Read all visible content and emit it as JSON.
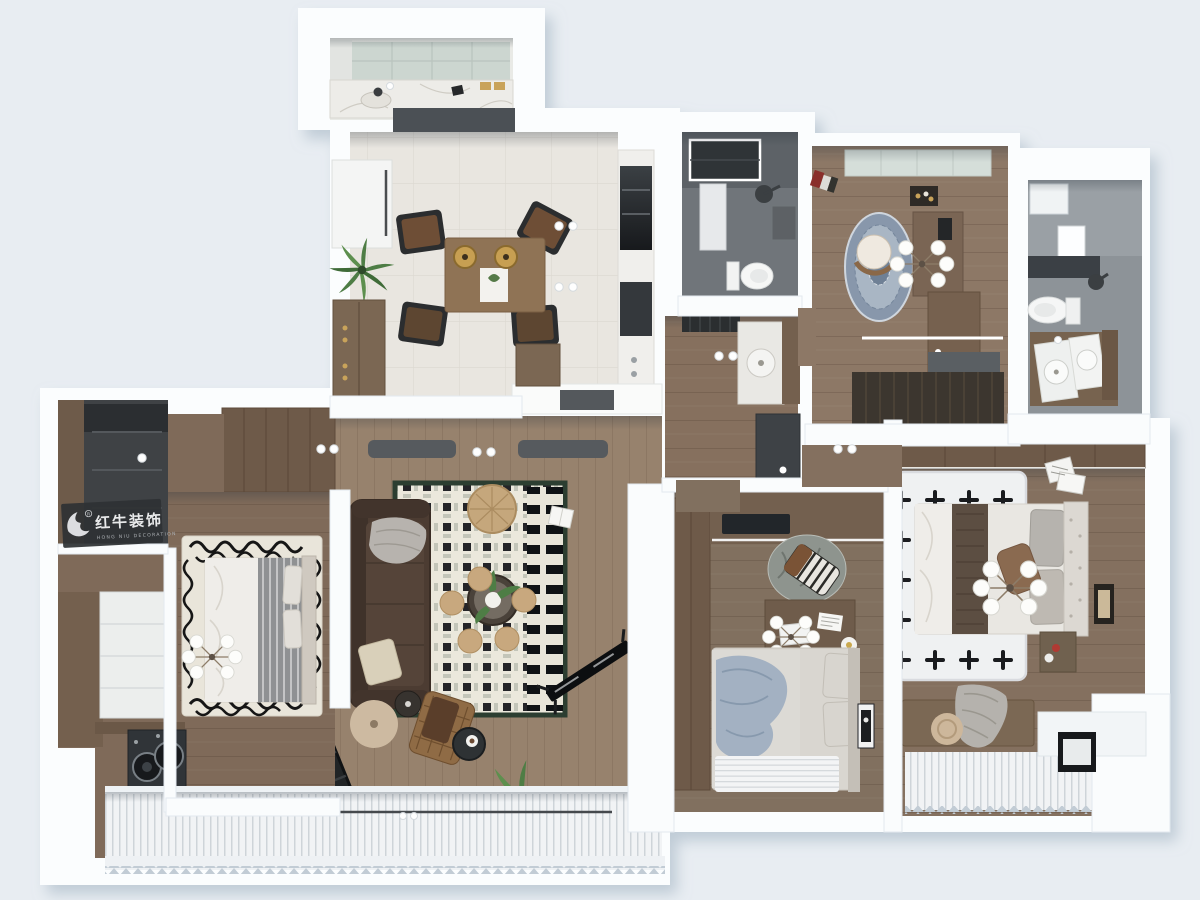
{
  "watermark": {
    "brand_cn": "红牛装饰",
    "brand_en": "HONG NIU DECORATION",
    "registered_mark": "R"
  },
  "palette": {
    "background": "#e8edf2",
    "wall": "#fbfdfe",
    "wall_edge": "#dde5ec",
    "wood_hall": "#97826d",
    "wood_bedroom": "#7f6a59",
    "wood_mid": "#81705f",
    "wood_master": "#84705f",
    "wood_study": "#8d7866",
    "wood_entry": "#86705e",
    "wardrobe_wood": "#6e5a49",
    "cabinet_wood": "#7b6753",
    "tile_light": "#e9e6e0",
    "counter_dark": "#4b5055",
    "marble": "#edece8",
    "bath_dark_floor": "#70757a",
    "bath_light_wall": "#9aa0a5",
    "bath_light_floor": "#8d9398",
    "skylight_green": "#ccd6d0",
    "skylight_pale": "#d5ded9",
    "sofa_leather": "#4c3c32",
    "rug_border_green": "#2c3e31",
    "rug_blue_outer": "#8897ab",
    "rug_blue_inner": "#a9b6c4",
    "pouf_tan": "#c8a87e",
    "rattan": "#c5a77c",
    "plant_green": "#4e7d45",
    "appliance_dark": "#303438",
    "tv_black": "#0c0e10",
    "bed_white": "#efede9",
    "bed_throw_brown": "#5c4e42",
    "bed_blanket_blue": "#a3b1c2",
    "bed_gray_stripe": "#8f9193",
    "watermark_bg": "#2e3134",
    "watermark_text": "#e8e9ea"
  },
  "rooms": [
    {
      "id": "utility-counter"
    },
    {
      "id": "kitchen-dining"
    },
    {
      "id": "bathroom-main"
    },
    {
      "id": "entry-powder"
    },
    {
      "id": "study"
    },
    {
      "id": "bathroom-ensuite"
    },
    {
      "id": "living-room"
    },
    {
      "id": "bedroom-west"
    },
    {
      "id": "bedroom-middle"
    },
    {
      "id": "bedroom-master"
    },
    {
      "id": "balcony"
    },
    {
      "id": "laundry"
    }
  ]
}
